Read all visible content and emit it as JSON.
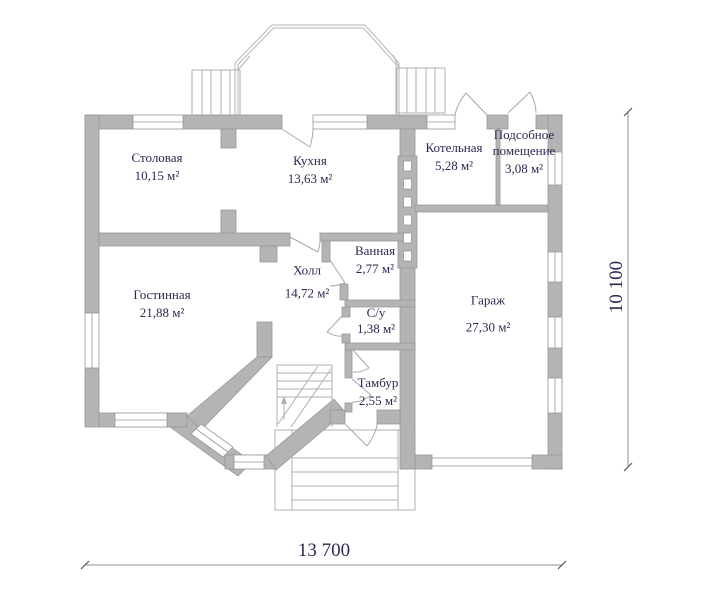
{
  "plan": {
    "rooms": [
      {
        "name": "Столовая",
        "area": "10,15 м²"
      },
      {
        "name": "Кухня",
        "area": "13,63 м²"
      },
      {
        "name": "Котельная",
        "area": "5,28 м²"
      },
      {
        "name": "Подсобное помещение",
        "area": "3,08 м²"
      },
      {
        "name": "Ванная",
        "area": "2,77 м²"
      },
      {
        "name": "Холл",
        "area": "14,72 м²"
      },
      {
        "name": "Гостинная",
        "area": "21,88 м²"
      },
      {
        "name": "С/у",
        "area": "1,38 м²"
      },
      {
        "name": "Гараж",
        "area": "27,30 м²"
      },
      {
        "name": "Тамбур",
        "area": "2,55 м²"
      }
    ],
    "dimensions": {
      "width": "13 700",
      "height": "10 100"
    },
    "colors": {
      "wall": "#b4b4b4",
      "outline": "#989898",
      "thin_line": "#b0b0b0",
      "text": "#2a2a52"
    }
  }
}
